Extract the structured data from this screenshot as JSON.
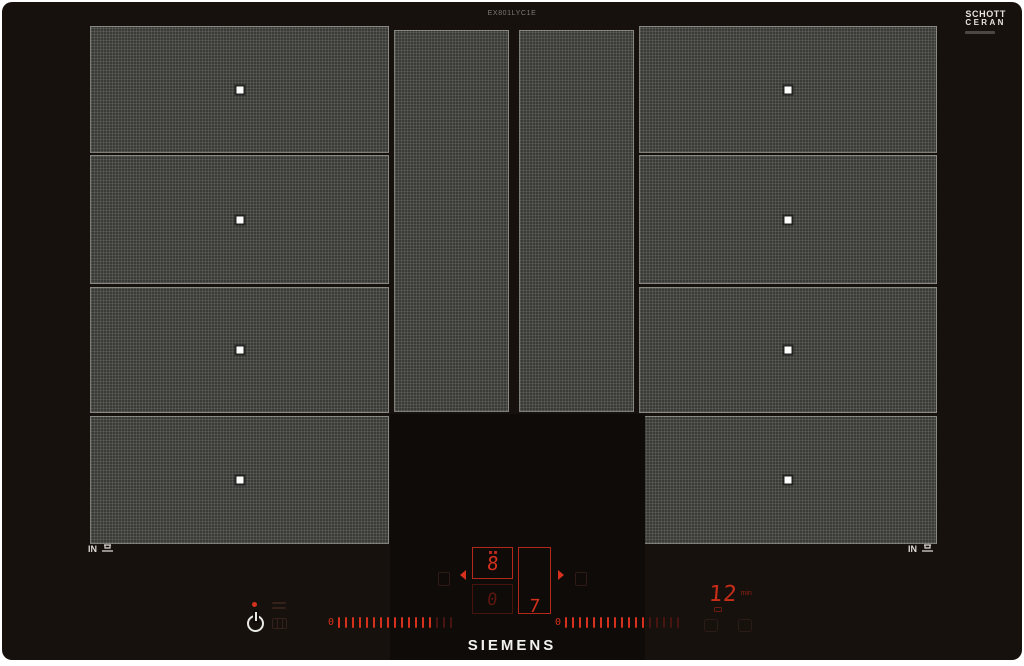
{
  "branding": {
    "model": "EX801LYC1E",
    "glass_logo": {
      "line1": "SCHOTT",
      "line2": "CERAN"
    },
    "manufacturer": "SIEMENS"
  },
  "surface_markings": {
    "left_in": "IN",
    "right_in": "IN"
  },
  "control_panel": {
    "zone_display": {
      "top_power": "8",
      "bottom_power": "0",
      "side_power": "7"
    },
    "timer": {
      "value": "12",
      "unit": "min"
    },
    "sliders": {
      "left": {
        "zero_label": "0",
        "bright": 14,
        "dim": 3
      },
      "right": {
        "zero_label": "0",
        "bright": 12,
        "dim": 5
      }
    },
    "colors": {
      "active_red": "#d5311c",
      "dim_red": "#5c170f",
      "text_white": "#f2f2ee"
    },
    "icons": [
      "power-icon",
      "main-switch-indicator-dot",
      "dim-dashes-icon",
      "dim-grid-icon",
      "zone-select-left-icon",
      "zone-select-right-icon",
      "arrow-left-icon",
      "arrow-right-icon",
      "timer-icon",
      "cleaning-lock-icon",
      "timer-setup-icon",
      "pan-icon"
    ]
  }
}
